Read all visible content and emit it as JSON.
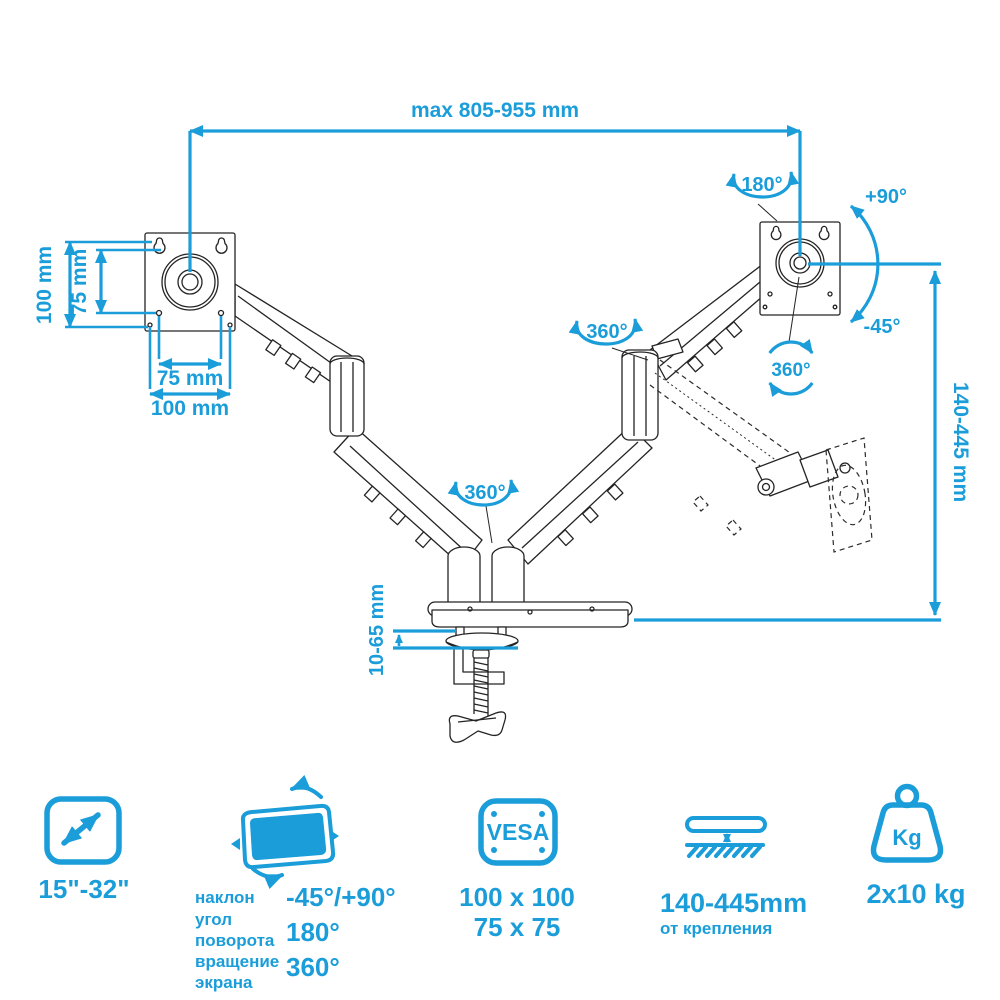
{
  "colors": {
    "accent": "#1A9DD9",
    "line": "#242424",
    "background": "#FFFFFF"
  },
  "dims": {
    "top_width": "max 805-955 mm",
    "plate_height_outer": "100 mm",
    "plate_height_inner": "75 mm",
    "plate_width_inner": "75 mm",
    "plate_width_outer": "100 mm",
    "height_range": "140-445 mm",
    "desk_thickness": "10-65 mm"
  },
  "angles": {
    "swivel": "180°",
    "tilt_up": "+90°",
    "tilt_down": "-45°",
    "rotation_plate": "360°",
    "rotation_elbow": "360°",
    "rotation_base": "360°"
  },
  "legend": {
    "screen_size": {
      "value": "15\"-32\""
    },
    "tilt": {
      "caption_lines": [
        "наклон",
        "угол",
        "поворота",
        "вращение",
        "экрана"
      ],
      "values": [
        "-45°/+90°",
        "180°",
        "360°"
      ]
    },
    "vesa": {
      "badge": "VESA",
      "values": [
        "100 x 100",
        "75 x 75"
      ]
    },
    "height": {
      "value": "140-445mm",
      "caption": "от крепления"
    },
    "weight": {
      "badge": "Kg",
      "value": "2x10 kg"
    }
  }
}
